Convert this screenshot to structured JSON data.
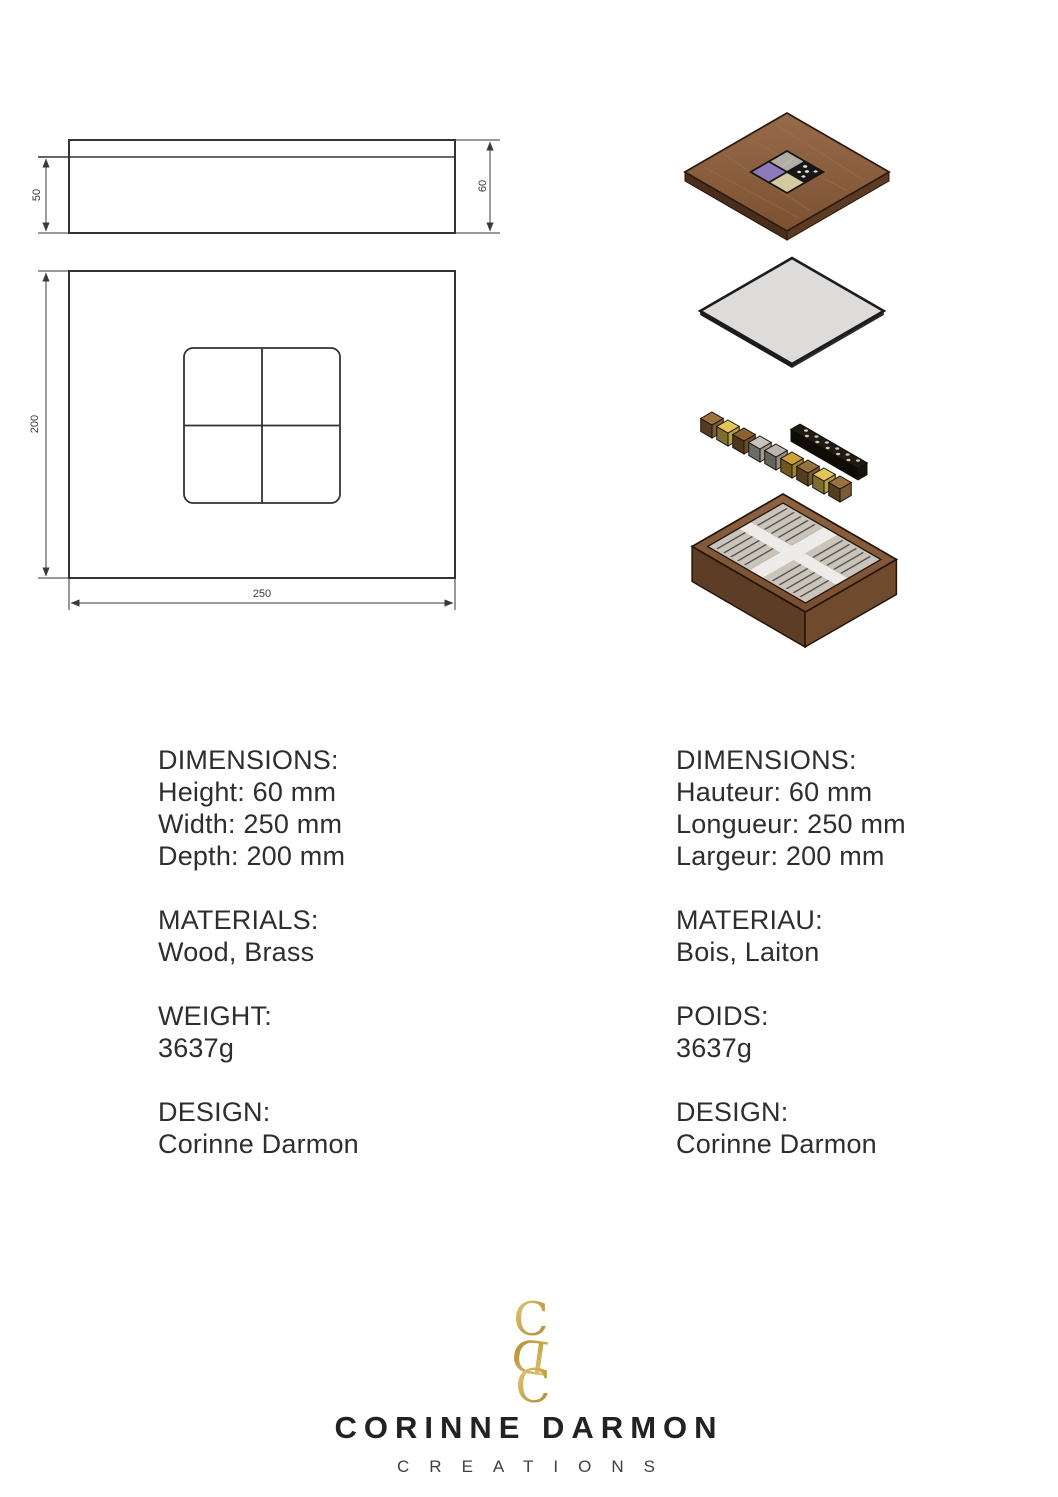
{
  "document": {
    "type": "product specification sheet",
    "product": "wooden jewelry box with brass inlay"
  },
  "technical_drawing": {
    "side_view": {
      "base_height": "50",
      "overall_height": "60"
    },
    "plan_view": {
      "depth": "200",
      "width": "250"
    }
  },
  "exploded_view": {
    "parts": [
      "lid-with-inlay",
      "flat-panel",
      "brass-cubes-and-perforated-bar",
      "box-with-dividers"
    ],
    "colors": {
      "wood": "#8a5f3e",
      "wood_dark": "#5e3d26",
      "panel": "#dedcda",
      "inlay_silver": "#b3ada7",
      "inlay_purple": "#8d7ab8",
      "inlay_black": "#181818",
      "inlay_cream": "#d5c9a0",
      "line": "#333333"
    },
    "cubes": [
      {
        "x": 712,
        "y": 412,
        "c": "#9a7242"
      },
      {
        "x": 728,
        "y": 420,
        "c": "#e2c65a"
      },
      {
        "x": 744,
        "y": 428,
        "c": "#8a6233"
      },
      {
        "x": 760,
        "y": 436,
        "c": "#c6c2bc"
      },
      {
        "x": 776,
        "y": 444,
        "c": "#b8b4ae"
      },
      {
        "x": 792,
        "y": 452,
        "c": "#c9a23c"
      },
      {
        "x": 808,
        "y": 460,
        "c": "#96703d"
      },
      {
        "x": 824,
        "y": 468,
        "c": "#e2c65a"
      },
      {
        "x": 840,
        "y": 476,
        "c": "#9a7242"
      }
    ]
  },
  "specs_en": {
    "title1": "DIMENSIONS:",
    "dim1": "Height: 60 mm",
    "dim2": "Width: 250 mm",
    "dim3": "Depth: 200 mm",
    "title2": "MATERIALS:",
    "materials": "Wood, Brass",
    "title3": "WEIGHT:",
    "weight": "3637g",
    "title4": "DESIGN:",
    "designer": "Corinne Darmon"
  },
  "specs_fr": {
    "title1": "DIMENSIONS:",
    "dim1": "Hauteur: 60 mm",
    "dim2": "Longueur: 250 mm",
    "dim3": "Largeur: 200 mm",
    "title2": "MATERIAU:",
    "materials": "Bois, Laiton",
    "title3": "POIDS:",
    "weight": "3637g",
    "title4": "DESIGN:",
    "designer": "Corinne Darmon"
  },
  "footer": {
    "monogram_top": "C",
    "monogram_mid": "D",
    "monogram_bottom": "C",
    "gold": "#c3a04a",
    "brand": "CORINNE DARMON",
    "tagline": "CREATIONS"
  }
}
